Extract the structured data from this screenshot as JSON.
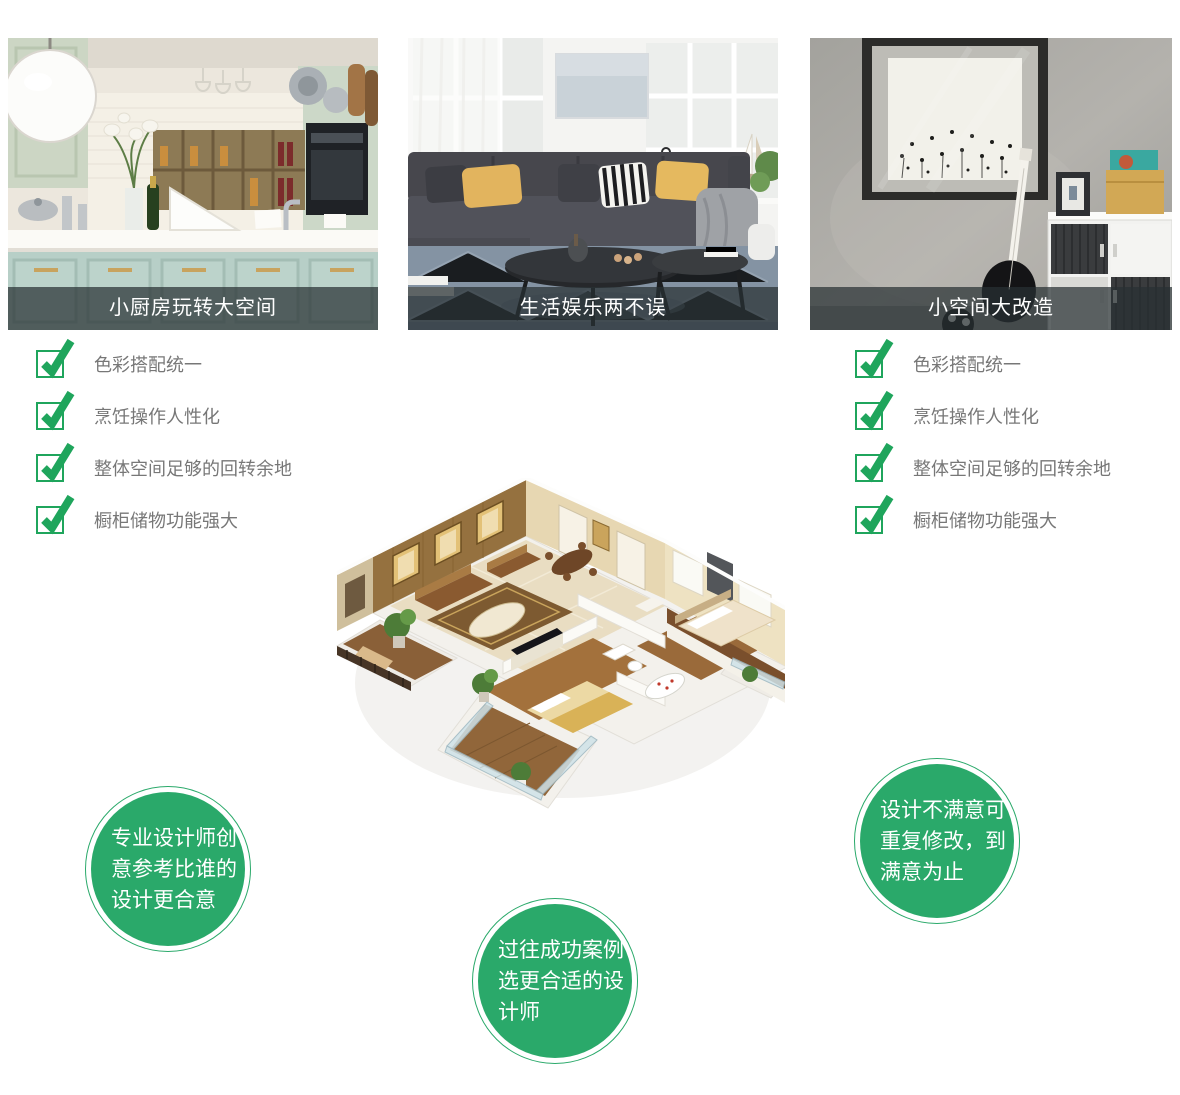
{
  "cards": [
    {
      "caption": "小厨房玩转大空间",
      "image": "kitchen-photo"
    },
    {
      "caption": "生活娱乐两不误",
      "image": "living-room-photo"
    },
    {
      "caption": "小空间大改造",
      "image": "small-space-photo"
    }
  ],
  "checklist_left": {
    "items": [
      "色彩搭配统一",
      "烹饪操作人性化",
      "整体空间足够的回转余地",
      "橱柜储物功能强大"
    ]
  },
  "checklist_right": {
    "items": [
      "色彩搭配统一",
      "烹饪操作人性化",
      "整体空间足够的回转余地",
      "橱柜储物功能强大"
    ]
  },
  "floorplan": {
    "image": "3d-apartment-floor-plan"
  },
  "badges": [
    {
      "text": "专业设计师创\n意参考比谁的\n设计更合意"
    },
    {
      "text": "过往成功案例\n选更合适的设\n计师"
    },
    {
      "text": "设计不满意可\n重复修改，到\n满意为止"
    }
  ],
  "colors": {
    "check_green": "#1fa55c",
    "badge_green": "#2aa96a",
    "caption_bg": "rgba(40,49,51,0.72)",
    "caption_text": "#ffffff",
    "list_text": "#777777"
  }
}
